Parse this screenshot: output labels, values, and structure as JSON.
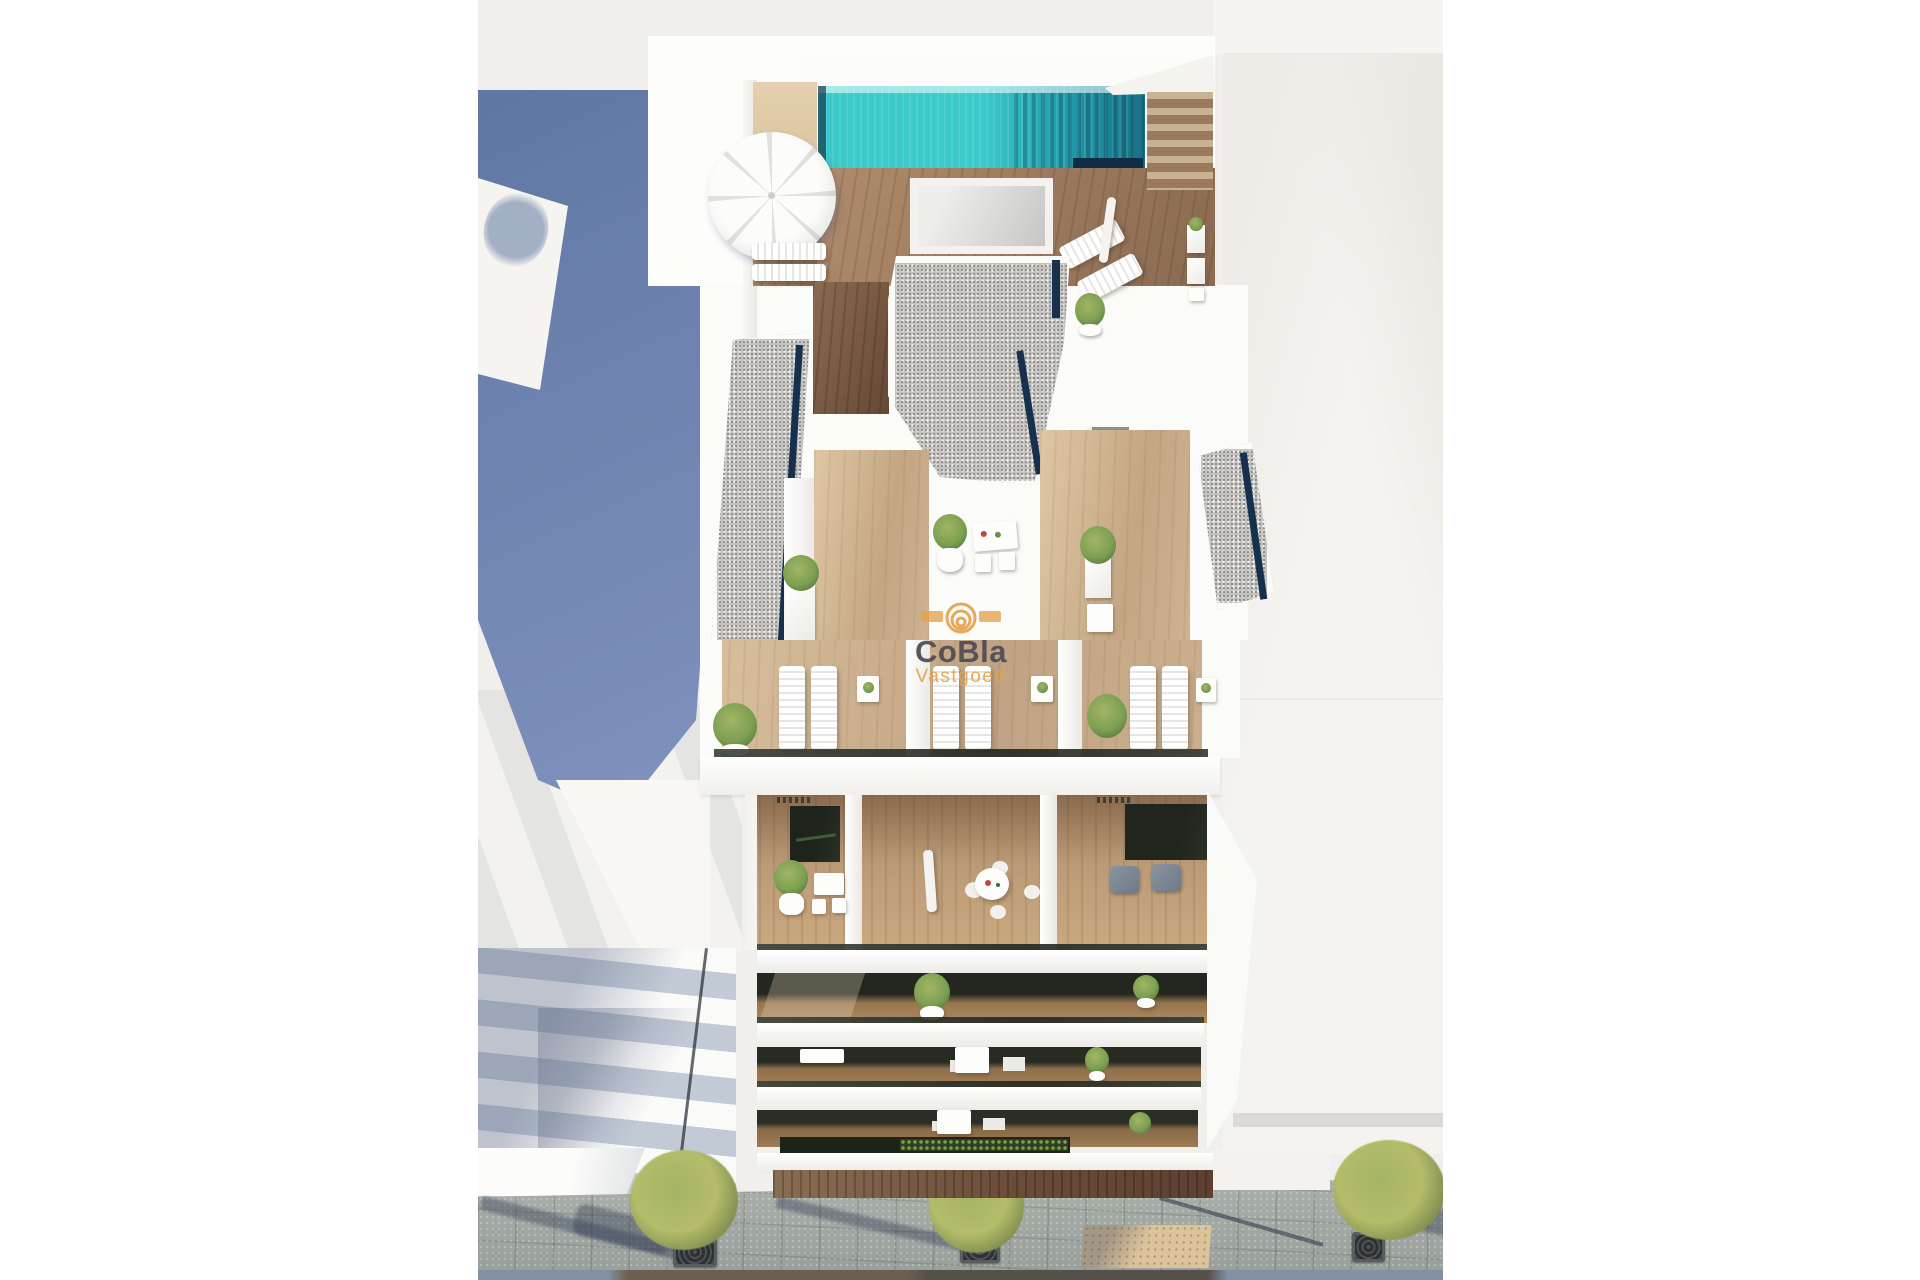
{
  "image": {
    "type": "3d-architectural-render",
    "description": "Aerial render of a modern white apartment building: rooftop solarium with swimming pool, parasol and sun loungers, penthouse gravel roofs and wooden terraces, a row of lounger terraces, stacked balconies with outdoor furniture and plants, adjacent buildings and a paved street with trees below",
    "watermark_present": true
  },
  "watermark": {
    "brand": "CoBla",
    "sub_brand": "Vastgoed",
    "logo": "spiral-fingerprint-logo"
  },
  "scene_elements": [
    "rooftop-pool",
    "pool-deck",
    "open-parasol",
    "closed-parasol",
    "sun-loungers",
    "gravel-roof",
    "penthouse-terrace",
    "potted-plants",
    "outdoor-tables",
    "balconies",
    "glass-balustrades",
    "gray-armchairs",
    "hedge-planter",
    "adjacent-building-facade",
    "cast-shadow",
    "street-pavement",
    "street-trees",
    "tree-grates",
    "tactile-paving",
    "road"
  ],
  "palette": {
    "bg_page": "#ffffff",
    "bg_render": "#f1efeb",
    "roof_white": "#f6f4f0",
    "shadow_blue_1": "#5f76a3",
    "shadow_blue_2": "#8294bf",
    "pool_teal": "#2cc0c2",
    "pool_teal_dark": "#157287",
    "pool_edge_navy": "#0f2c44",
    "wood_tan": "#dcc6a2",
    "navy_edge": "#16304d",
    "gravel": "#c4c3c0",
    "gravel_dot": "#8f8e8c",
    "facade_band": "#c2cad6",
    "plant_green": "#7ca052",
    "plant_light": "#a3b465",
    "tree_street": "#b5bc6a",
    "tree_shade": "#75854a",
    "pavement": "#a3a9a4",
    "grate": "#2d3133",
    "tactile": "#dbc39b",
    "road_brown": "#6b5f52",
    "road_blue": "#8191a3",
    "wm_orange": "#e5a24d",
    "wm_dark": "#4e4c52"
  }
}
